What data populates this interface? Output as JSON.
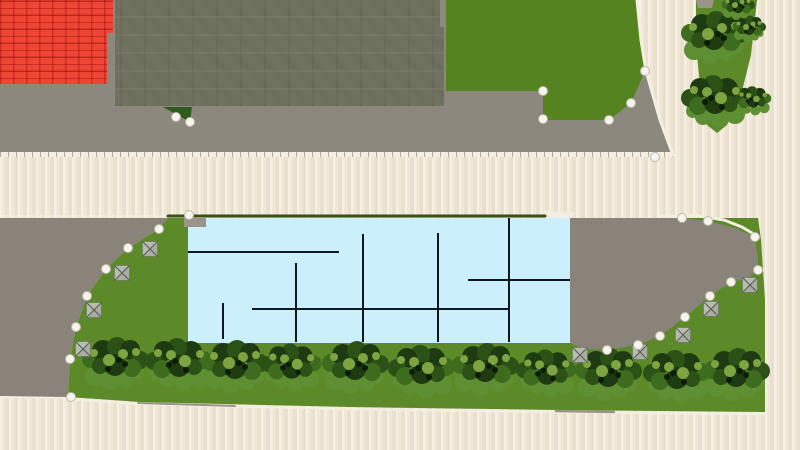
{
  "scene": {
    "canvas": {
      "width": 800,
      "height": 450
    },
    "colors": {
      "road": "#f1e8d7",
      "pavement": "#8d887d",
      "parcel_pavement": "#8a8379",
      "red_roof": "#ee4534",
      "olive_roof": "#6f725e",
      "grass": "#55831f",
      "lawn": "#5d8a29",
      "floor": "#cbeffb",
      "wall_line": "#111722",
      "edge_dark_green": "#3a4f15",
      "curb": "#f4efe2",
      "marker_fill": "#f6f4ed",
      "marker_stroke": "#bdb9ab",
      "pyramid_fill": "#b8bcb2",
      "pyramid_line": "#5d6156",
      "patch_green": "#2e5a1d",
      "white_patch": "#f2efe6",
      "gray_patch": "#9a948a",
      "tree_shadow": "#5f8f33",
      "tree_dark": "#1d3a10",
      "tree_dark2": "#2b5116",
      "tree_mid": "#3e6c1e",
      "tree_light": "#7ea441",
      "tree_darkest": "#0b1d06"
    },
    "regions": {
      "top-pavement": {
        "fill": "pavement",
        "points": [
          [
            0,
            0
          ],
          [
            637,
            0
          ],
          [
            641,
            40
          ],
          [
            646,
            71
          ],
          [
            660,
            120
          ],
          [
            673,
            157
          ],
          [
            0,
            157
          ]
        ]
      },
      "red-roof-building": {
        "fill": "red_roof",
        "points": [
          [
            0,
            0
          ],
          [
            113,
            0
          ],
          [
            113,
            33
          ],
          [
            107,
            33
          ],
          [
            107,
            84
          ],
          [
            0,
            84
          ]
        ]
      },
      "olive-roof-building": {
        "fill": "olive_roof",
        "points": [
          [
            115,
            0
          ],
          [
            440,
            0
          ],
          [
            440,
            27
          ],
          [
            444,
            27
          ],
          [
            444,
            106
          ],
          [
            115,
            106
          ]
        ]
      },
      "top-grass": {
        "fill": "grass",
        "points": [
          [
            446,
            0
          ],
          [
            637,
            0
          ],
          [
            641,
            40
          ],
          [
            645,
            71
          ],
          [
            631,
            103
          ],
          [
            609,
            120
          ],
          [
            543,
            120
          ],
          [
            543,
            91
          ],
          [
            446,
            91
          ]
        ]
      },
      "median-strip": {
        "fill": "lawn",
        "points": [
          [
            696,
            0
          ],
          [
            757,
            0
          ],
          [
            751,
            55
          ],
          [
            741,
            95
          ],
          [
            727,
            125
          ],
          [
            717,
            133
          ],
          [
            707,
            125
          ],
          [
            700,
            85
          ],
          [
            696,
            45
          ]
        ]
      },
      "parcel-pavement-left": {
        "fill": "parcel_pavement",
        "points": [
          [
            0,
            218
          ],
          [
            168,
            218
          ],
          [
            159,
            229
          ],
          [
            128,
            248
          ],
          [
            106,
            269
          ],
          [
            87,
            296
          ],
          [
            76,
            327
          ],
          [
            70,
            359
          ],
          [
            68,
            397
          ],
          [
            0,
            397
          ]
        ]
      },
      "parcel-lawn": {
        "fill": "lawn",
        "points": [
          [
            168,
            218
          ],
          [
            758,
            218
          ],
          [
            761,
            240
          ],
          [
            765,
            300
          ],
          [
            765,
            412
          ],
          [
            560,
            410
          ],
          [
            350,
            407
          ],
          [
            140,
            402
          ],
          [
            68,
            397
          ],
          [
            70,
            359
          ],
          [
            76,
            327
          ],
          [
            87,
            296
          ],
          [
            106,
            269
          ],
          [
            128,
            248
          ],
          [
            159,
            229
          ]
        ]
      },
      "parcel-pavement-right": {
        "fill": "parcel_pavement",
        "points": [
          [
            570,
            218
          ],
          [
            682,
            218
          ],
          [
            708,
            221
          ],
          [
            735,
            228
          ],
          [
            755,
            237
          ],
          [
            758,
            258
          ],
          [
            758,
            270
          ],
          [
            748,
            278
          ],
          [
            731,
            282
          ],
          [
            710,
            296
          ],
          [
            685,
            317
          ],
          [
            660,
            336
          ],
          [
            638,
            345
          ],
          [
            607,
            350
          ],
          [
            584,
            349
          ],
          [
            570,
            343
          ]
        ]
      },
      "building-floorplan": {
        "fill": "floor",
        "points": [
          [
            188,
            218
          ],
          [
            570,
            218
          ],
          [
            570,
            343
          ],
          [
            188,
            343
          ]
        ]
      }
    },
    "patches": [
      {
        "name": "median-top-paving",
        "fill": "gray_patch",
        "points": [
          [
            696,
            0
          ],
          [
            714,
            0
          ],
          [
            712,
            8
          ],
          [
            698,
            8
          ]
        ]
      },
      {
        "name": "small-grass-triangle",
        "fill": "patch_green",
        "points": [
          [
            163,
            107
          ],
          [
            192,
            107
          ],
          [
            190,
            122
          ]
        ]
      },
      {
        "name": "floorplan-white-corner",
        "fill": "white_patch",
        "points": [
          [
            545,
            211
          ],
          [
            576,
            213
          ],
          [
            570,
            218
          ],
          [
            545,
            218
          ]
        ]
      },
      {
        "name": "floorplan-gray-corner",
        "fill": "gray_patch",
        "points": [
          [
            184,
            218
          ],
          [
            206,
            218
          ],
          [
            206,
            227
          ],
          [
            184,
            227
          ]
        ]
      }
    ],
    "edge_lines": [
      {
        "name": "road-corner-curb",
        "color": "curb",
        "width": 3,
        "points": [
          [
            637,
            0
          ],
          [
            641,
            40
          ],
          [
            646,
            71
          ],
          [
            660,
            120
          ],
          [
            673,
            155
          ]
        ]
      },
      {
        "name": "left-road-curb",
        "color": "curb",
        "width": 1.5,
        "points": [
          [
            0,
            216
          ],
          [
            166,
            216
          ]
        ]
      },
      {
        "name": "parcel-top-edge-line",
        "color": "edge_dark_green",
        "width": 3,
        "points": [
          [
            168,
            216
          ],
          [
            545,
            216
          ]
        ]
      },
      {
        "name": "parcel-top-curb",
        "color": "curb",
        "width": 3,
        "points": [
          [
            660,
            216
          ],
          [
            700,
            216
          ],
          [
            724,
            220
          ],
          [
            742,
            227
          ],
          [
            757,
            236
          ]
        ]
      },
      {
        "name": "bottom-curb",
        "color": "curb",
        "width": 2.5,
        "points": [
          [
            68,
            399
          ],
          [
            140,
            404
          ],
          [
            350,
            409
          ],
          [
            560,
            412
          ],
          [
            764,
            414
          ]
        ]
      },
      {
        "name": "bottom-curb-gray-1",
        "color": "gray_patch",
        "width": 2,
        "points": [
          [
            138,
            403
          ],
          [
            235,
            406
          ]
        ]
      },
      {
        "name": "bottom-curb-gray-2",
        "color": "gray_patch",
        "width": 2.5,
        "points": [
          [
            556,
            411
          ],
          [
            614,
            412
          ]
        ]
      },
      {
        "name": "bottom-left-road-curb",
        "color": "curb",
        "width": 2,
        "points": [
          [
            0,
            397
          ],
          [
            68,
            398
          ]
        ]
      }
    ],
    "wall_lines": [
      [
        296,
        263,
        296,
        342
      ],
      [
        363,
        234,
        363,
        342
      ],
      [
        438,
        233,
        438,
        342
      ],
      [
        509,
        218,
        509,
        342
      ],
      [
        223,
        303,
        223,
        339
      ],
      [
        188,
        252,
        339,
        252
      ],
      [
        252,
        309,
        510,
        309
      ],
      [
        468,
        280,
        570,
        280
      ]
    ],
    "markers": {
      "vertices": [
        [
          176,
          117
        ],
        [
          190,
          122
        ],
        [
          543,
          91
        ],
        [
          543,
          119
        ],
        [
          609,
          120
        ],
        [
          631,
          103
        ],
        [
          645,
          71
        ],
        [
          655,
          157
        ],
        [
          189,
          215
        ],
        [
          159,
          229
        ],
        [
          128,
          248
        ],
        [
          106,
          269
        ],
        [
          87,
          296
        ],
        [
          76,
          327
        ],
        [
          70,
          359
        ],
        [
          71,
          397
        ],
        [
          682,
          218
        ],
        [
          708,
          221
        ],
        [
          755,
          237
        ],
        [
          758,
          270
        ],
        [
          731,
          282
        ],
        [
          710,
          296
        ],
        [
          685,
          317
        ],
        [
          660,
          336
        ],
        [
          638,
          345
        ],
        [
          607,
          350
        ]
      ],
      "pyramids": [
        [
          150,
          249
        ],
        [
          122,
          273
        ],
        [
          94,
          310
        ],
        [
          83,
          349
        ],
        [
          580,
          355
        ],
        [
          640,
          352
        ],
        [
          683,
          335
        ],
        [
          711,
          309
        ],
        [
          750,
          285
        ]
      ]
    },
    "tree_template": [
      [
        -22,
        14,
        10,
        "tree_shadow"
      ],
      [
        -6,
        19,
        9,
        "tree_shadow"
      ],
      [
        10,
        17,
        8,
        "tree_shadow"
      ],
      [
        20,
        11,
        7,
        "tree_shadow"
      ],
      [
        -26,
        -3,
        9,
        "tree_mid"
      ],
      [
        -14,
        -11,
        11,
        "tree_dark"
      ],
      [
        0,
        -15,
        10,
        "tree_dark2"
      ],
      [
        13,
        -12,
        10,
        "tree_dark"
      ],
      [
        23,
        -2,
        9,
        "tree_dark2"
      ],
      [
        15,
        6,
        9,
        "tree_mid"
      ],
      [
        -2,
        3,
        11,
        "tree_dark"
      ],
      [
        -17,
        4,
        8,
        "tree_dark2"
      ],
      [
        -8,
        -2,
        6,
        "tree_light"
      ],
      [
        6,
        -8,
        5,
        "tree_light"
      ],
      [
        19,
        -10,
        4,
        "tree_light"
      ],
      [
        -23,
        -9,
        4,
        "tree_light"
      ],
      [
        2,
        -2,
        3,
        "tree_darkest"
      ],
      [
        -9,
        7,
        3,
        "tree_darkest"
      ],
      [
        8,
        2,
        3,
        "tree_darkest"
      ]
    ],
    "trees": {
      "row": [
        [
          117,
          362
        ],
        [
          177,
          363
        ],
        [
          237,
          365
        ],
        [
          290,
          366,
          0.9
        ],
        [
          357,
          366
        ],
        [
          420,
          370
        ],
        [
          487,
          368
        ],
        [
          545,
          372,
          0.9
        ],
        [
          610,
          373
        ],
        [
          675,
          375
        ],
        [
          738,
          373
        ]
      ],
      "median": [
        [
          716,
          36
        ],
        [
          713,
          100
        ],
        [
          750,
          28,
          0.5
        ],
        [
          752,
          100,
          0.55
        ],
        [
          739,
          6,
          0.5
        ]
      ]
    }
  }
}
